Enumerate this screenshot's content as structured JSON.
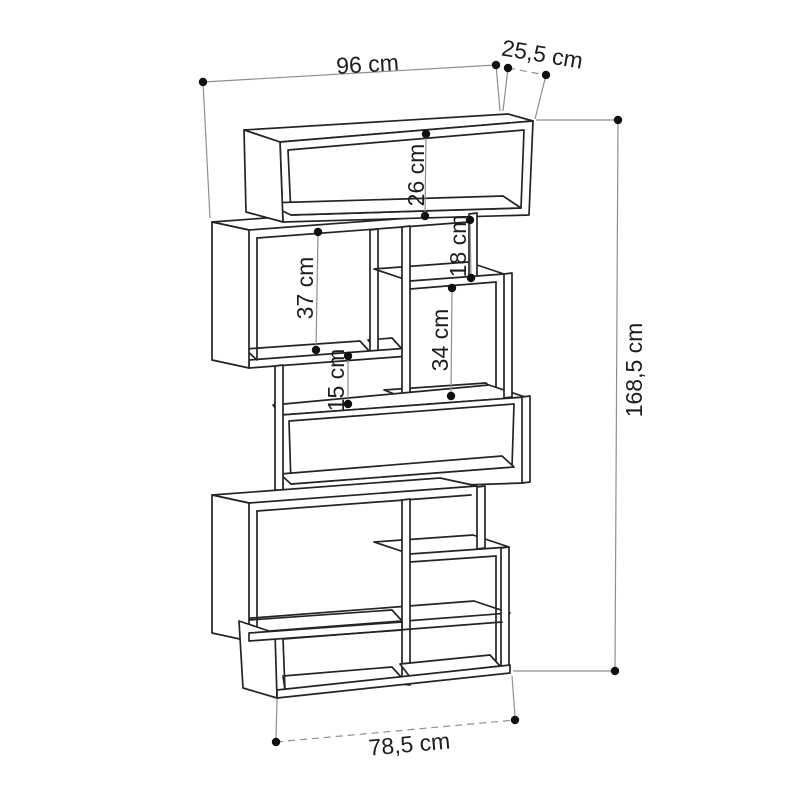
{
  "diagram": {
    "unit": "cm",
    "style": {
      "line_color": "#242424",
      "dim_color": "#8f8f8f",
      "background": "#ffffff"
    },
    "dims": {
      "width_top": "96 cm",
      "depth": "25,5 cm",
      "top_box_height": "26 cm",
      "shelf_18": "18 cm",
      "shelf_37": "37 cm",
      "shelf_34": "34 cm",
      "shelf_15": "15 cm",
      "total_height": "168,5 cm",
      "width_bottom": "78,5 cm"
    }
  }
}
